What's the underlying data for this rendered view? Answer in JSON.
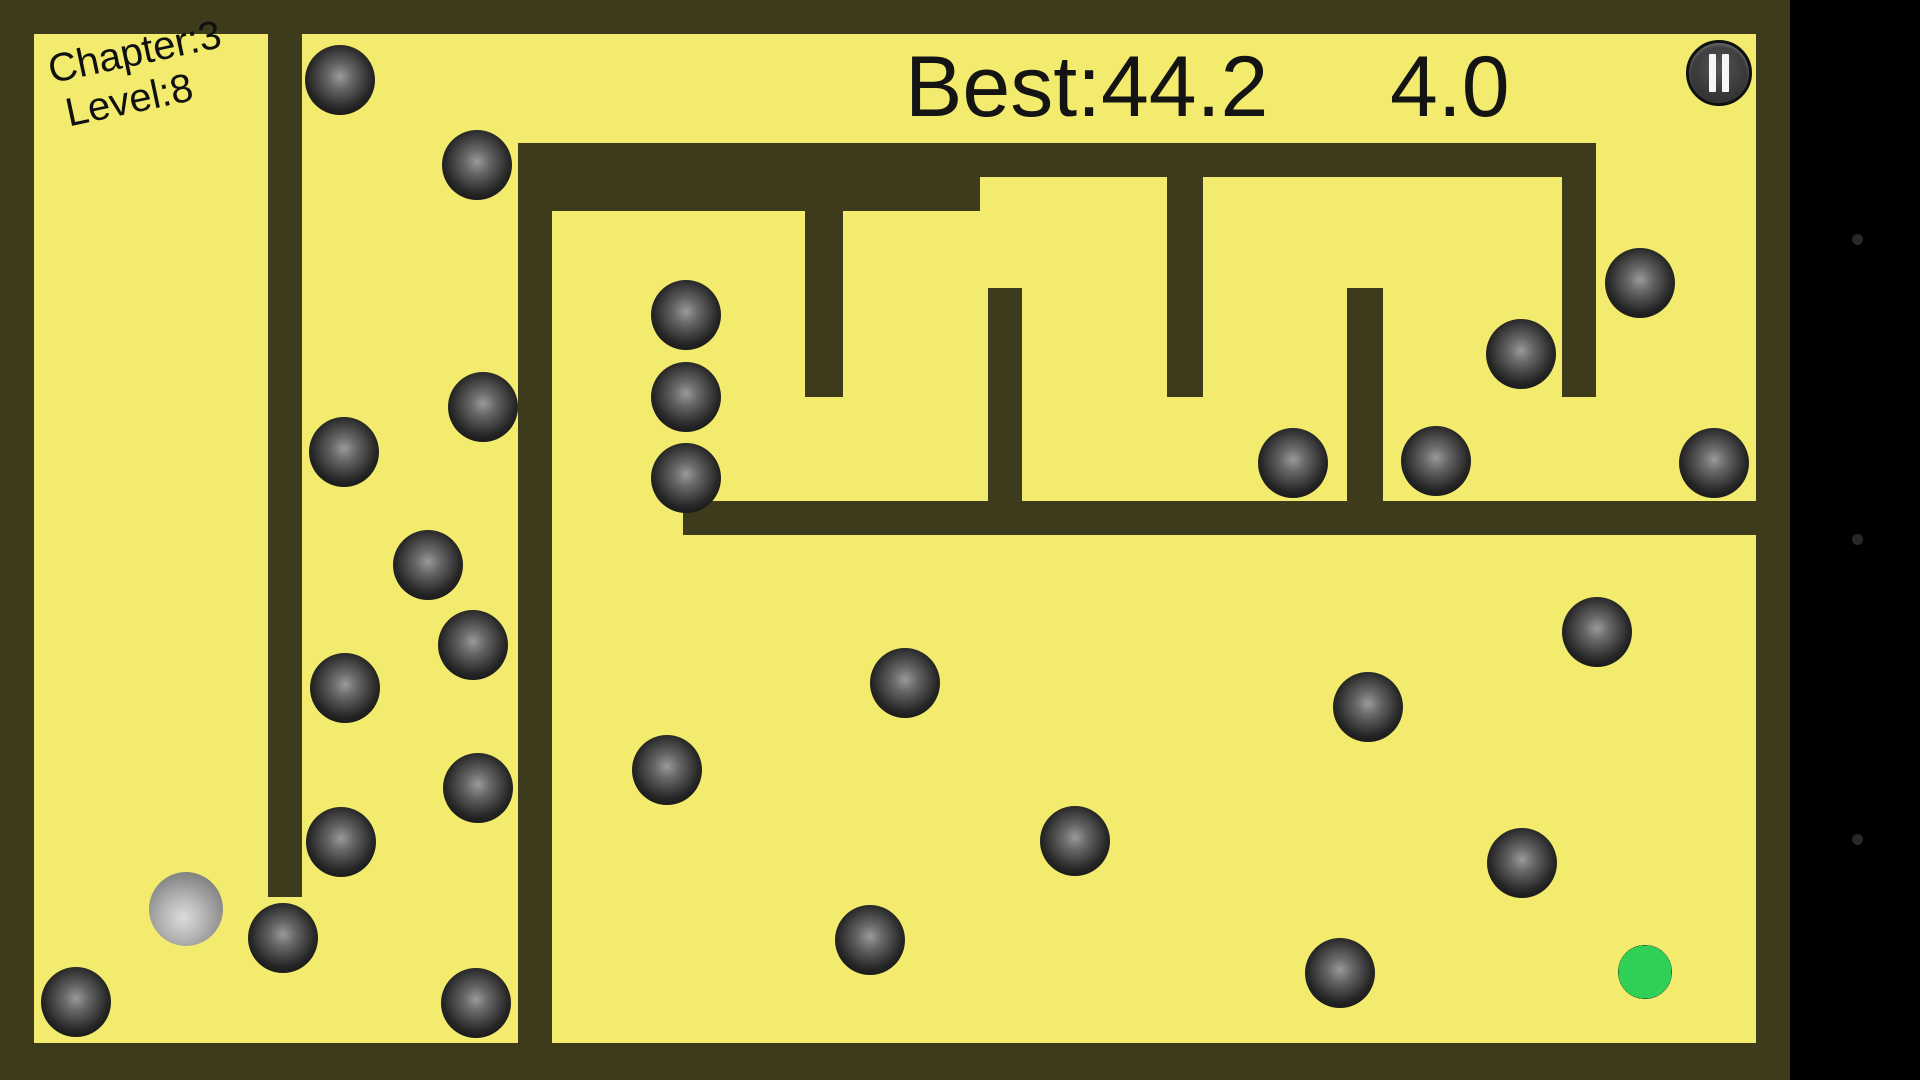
{
  "hud": {
    "chapter_line1": "Chapter:3",
    "chapter_line2": "Level:8",
    "best_score": "Best:44.2",
    "timer": "4.0",
    "pause_icon": "pause-icon"
  },
  "colors": {
    "background": "#000000",
    "field": "#F2EB6D",
    "wall": "#3E3A1C",
    "hud_text": "#141414",
    "goal_green": "#2FD058",
    "nav_dot": "#282828"
  },
  "field": {
    "x": 0,
    "y": 0,
    "width": 1790,
    "height": 1080
  },
  "maze": {
    "walls": [
      {
        "name": "border-top",
        "x": 0,
        "y": 0,
        "w": 1790,
        "h": 34
      },
      {
        "name": "border-left",
        "x": 0,
        "y": 0,
        "w": 34,
        "h": 1080
      },
      {
        "name": "border-bottom",
        "x": 0,
        "y": 1043,
        "w": 1790,
        "h": 37
      },
      {
        "name": "border-right",
        "x": 1756,
        "y": 0,
        "w": 34,
        "h": 1080
      },
      {
        "name": "wall-vertical-left",
        "x": 268,
        "y": 34,
        "w": 34,
        "h": 863
      },
      {
        "name": "wall-vertical-main",
        "x": 518,
        "y": 143,
        "w": 34,
        "h": 900
      },
      {
        "name": "wall-top-horizontal",
        "x": 518,
        "y": 143,
        "w": 1078,
        "h": 34
      },
      {
        "name": "wall-second-horizontal",
        "x": 552,
        "y": 177,
        "w": 428,
        "h": 34
      },
      {
        "name": "wall-right-tooth",
        "x": 1562,
        "y": 177,
        "w": 34,
        "h": 220
      },
      {
        "name": "tooth-hanging-1",
        "x": 805,
        "y": 211,
        "w": 38,
        "h": 186
      },
      {
        "name": "post-rising-1",
        "x": 988,
        "y": 288,
        "w": 34,
        "h": 213
      },
      {
        "name": "tooth-hanging-2",
        "x": 1167,
        "y": 177,
        "w": 36,
        "h": 220
      },
      {
        "name": "post-rising-2",
        "x": 1347,
        "y": 288,
        "w": 36,
        "h": 213
      },
      {
        "name": "wall-middle-horizontal",
        "x": 683,
        "y": 501,
        "w": 1073,
        "h": 34
      }
    ]
  },
  "balls": {
    "obstacle_radius": 35,
    "obstacles": [
      [
        340,
        80
      ],
      [
        477,
        165
      ],
      [
        686,
        315
      ],
      [
        686,
        397
      ],
      [
        686,
        478
      ],
      [
        483,
        407
      ],
      [
        344,
        452
      ],
      [
        428,
        565
      ],
      [
        473,
        645
      ],
      [
        345,
        688
      ],
      [
        478,
        788
      ],
      [
        341,
        842
      ],
      [
        283,
        938
      ],
      [
        476,
        1003
      ],
      [
        76,
        1002
      ],
      [
        667,
        770
      ],
      [
        905,
        683
      ],
      [
        870,
        940
      ],
      [
        1075,
        841
      ],
      [
        1293,
        463
      ],
      [
        1436,
        461
      ],
      [
        1640,
        283
      ],
      [
        1521,
        354
      ],
      [
        1714,
        463
      ],
      [
        1597,
        632
      ],
      [
        1368,
        707
      ],
      [
        1522,
        863
      ],
      [
        1340,
        973
      ]
    ],
    "player": {
      "x": 186,
      "y": 909,
      "r": 37
    },
    "goal": {
      "x": 1645,
      "y": 972,
      "r": 27
    }
  },
  "letterbox": {
    "right_strip": {
      "x": 1790,
      "width": 130
    },
    "nav_dots": [
      {
        "x": 1857,
        "y": 239
      },
      {
        "x": 1857,
        "y": 539
      },
      {
        "x": 1857,
        "y": 839
      }
    ]
  }
}
